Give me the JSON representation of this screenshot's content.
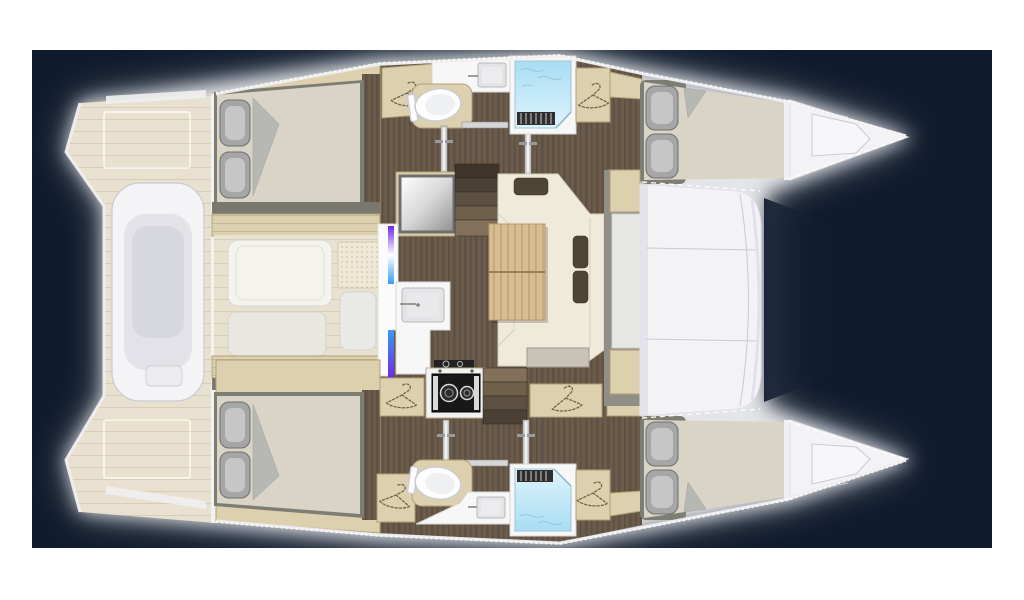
{
  "document": {
    "kind": "catamaran-floor-plan",
    "view": "top-down deck plan, bows pointing right",
    "background": "dark navy panel centered on white page with soft white glow around hull"
  },
  "palette": {
    "page_bg": "#ffffff",
    "panel_bg": "#0f1a2c",
    "glow": "#ffffff",
    "deck_wood": "#e9e1cf",
    "deck_plank_line": "#d7cdb8",
    "floor_walnut": "#6a5b4a",
    "floor_walnut_streak": "#574a3c",
    "cabinet_oak": "#ddd0af",
    "cabinet_oak_edge": "#afa076",
    "wall_gray": "#7a786e",
    "bed_frame": "#7e7d73",
    "mattress": "#d9d4c6",
    "pillow": "#a6a6a6",
    "pillow_hi": "#c6c6c6",
    "pillow_edge": "#6f6f6f",
    "sheet_fold": "#b7b7b4",
    "sofa_cream": "#efead9",
    "sofa_seam": "#d7d1bc",
    "cushion_brown": "#4e4536",
    "table_wood": "#d6bd92",
    "table_grain": "#c0a374",
    "table_seam": "#9a7d52",
    "sideboard_gray": "#c8c3b6",
    "counter_white": "#f7f7f7",
    "sink_fill": "#e4e4e6",
    "sink_edge": "#b9b9bd",
    "porcelain": "#fdfdfd",
    "porcelain_shade": "#c9ccd1",
    "shower_blue_deep": "#a8ddf3",
    "shower_blue_light": "#dff3fc",
    "wave_line": "#8fc3dc",
    "grate_dark": "#2e2e2e",
    "grate_line": "#cfcfcf",
    "stove_black": "#181818",
    "stove_white": "#f2f2f2",
    "stove_ring": "#d9d9d9",
    "accent_purple": "#6d28e8",
    "accent_blue": "#3a9df0",
    "deck_white": "#f3f3f6",
    "deck_white_shade": "#d9d9e4",
    "seam_gray": "#c9c9d4",
    "tramp_shadow": "#1a2438",
    "hanger_line": "#6f6450",
    "door_gray": "#d6d6d6",
    "door_edge": "#8a8a8a",
    "hull_stroke": "#efeff2",
    "dash_white": "#ffffff",
    "dinghy": "#f4f4f6",
    "dinghy_inner": "#e2e2e8",
    "dinghy_edge": "#c9c9d2"
  },
  "areas": [
    {
      "id": "aft-deck",
      "label": "Aft deck with dinghy and twin transom steps"
    },
    {
      "id": "cockpit",
      "label": "Aft cockpit seating pads"
    },
    {
      "id": "salon",
      "label": "Salon with corner sofa, cushions and folding table"
    },
    {
      "id": "galley",
      "label": "Galley sink, two-burner stove and companionway stairs"
    },
    {
      "id": "cabin-aft-top",
      "label": "Aft double cabin (upper hull) with pillows and turned sheet"
    },
    {
      "id": "head-top",
      "label": "Head (upper hull): toilet, vanity sink, shower, wardrobes"
    },
    {
      "id": "cabin-fwd-top",
      "label": "Forward double cabin (upper hull)"
    },
    {
      "id": "cabin-aft-bottom",
      "label": "Aft double cabin (lower hull) with pillows and turned sheet"
    },
    {
      "id": "head-bottom",
      "label": "Head (lower hull): toilet, vanity sink, shower, wardrobes"
    },
    {
      "id": "cabin-fwd-bottom",
      "label": "Forward double cabin (lower hull)"
    },
    {
      "id": "foredeck",
      "label": "Foredeck between hulls with deck seams"
    },
    {
      "id": "bow-decks",
      "label": "Twin bow decks with hatches, lifelines and trampoline shadow"
    }
  ]
}
